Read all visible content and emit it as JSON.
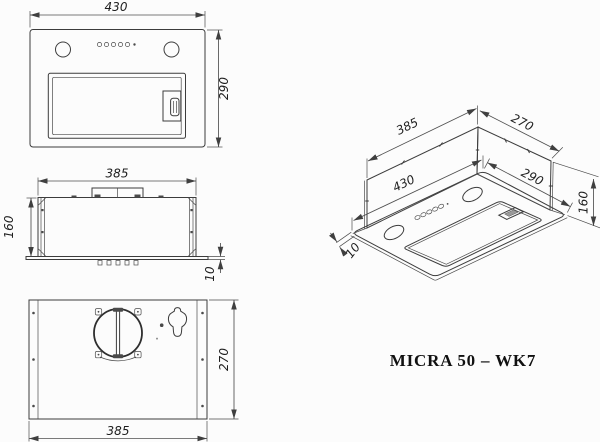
{
  "drawing": {
    "model": "MICRA 50 – WK7",
    "views": {
      "front": {
        "dim_width": "430",
        "dim_height": "290"
      },
      "side": {
        "dim_width": "385",
        "dim_height": "160",
        "dim_flange_thickness": "10"
      },
      "plan": {
        "dim_width": "385",
        "dim_depth": "270"
      },
      "iso": {
        "dim_body_width": "385",
        "dim_body_depth": "270",
        "dim_flange_width": "430",
        "dim_flange_depth": "290",
        "dim_height": "160",
        "dim_flange_thickness": "10"
      }
    },
    "colors": {
      "line": "#3c3c3c",
      "dimension": "#4f4f4f",
      "text": "#1e1e1e",
      "background": "#fcfcfc"
    }
  }
}
